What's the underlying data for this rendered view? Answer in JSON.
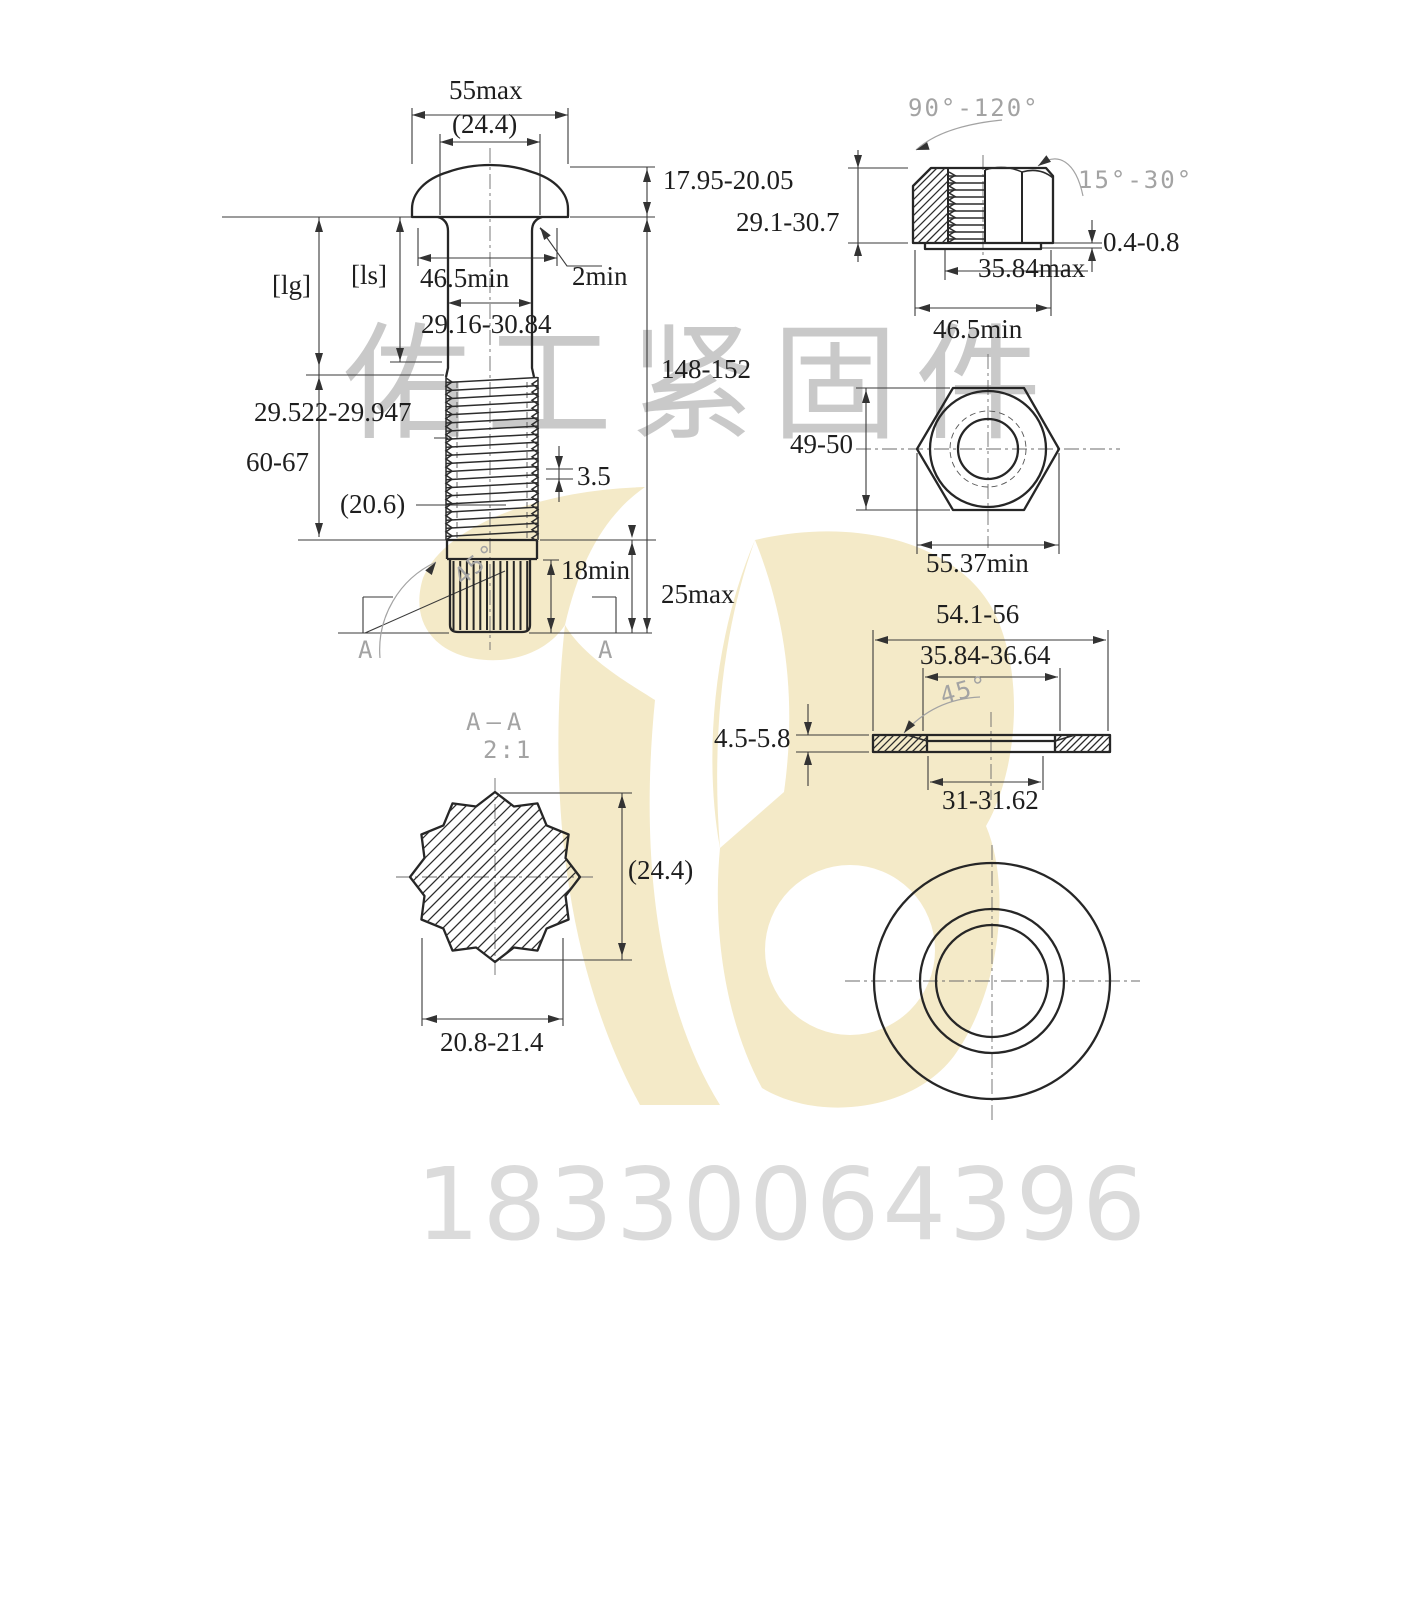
{
  "watermark": {
    "company": "佑工紧固件",
    "phone": "18330064396"
  },
  "bolt": {
    "head_width_max": "55max",
    "head_ref_dia": "(24.4)",
    "head_height": "17.95-20.05",
    "grip_ref": "[lg]",
    "shank_ref": "[ls]",
    "bearing_dia_min": "46.5min",
    "fillet_min": "2min",
    "shank_dia": "29.16-30.84",
    "overall_length": "148-152",
    "thread_major_dia": "29.522-29.947",
    "thread_length": "60-67",
    "thread_ref_dia": "(20.6)",
    "thread_pitch": "3.5",
    "chamfer_angle": "45°",
    "spline_length_min": "18min",
    "end_length_max": "25max",
    "section_mark_left": "A",
    "section_mark_right": "A"
  },
  "nut": {
    "countersink_angle": "90°-120°",
    "thread_chamfer_angle": "15°-30°",
    "height": "29.1-30.7",
    "washer_face_height": "0.4-0.8",
    "thread_dia_max": "35.84max",
    "bearing_dia_min": "46.5min",
    "across_flats": "49-50",
    "across_corners_min": "55.37min"
  },
  "washer": {
    "outer_dia": "54.1-56",
    "recess_dia": "35.84-36.64",
    "chamfer_angle": "45°",
    "thickness": "4.5-5.8",
    "inner_dia": "31-31.62"
  },
  "section_aa": {
    "title": "A—A",
    "scale": "2:1",
    "od_ref": "(24.4)",
    "spline_dia": "20.8-21.4"
  },
  "colors": {
    "paper": "#ffffff",
    "line": "#262626",
    "dimension": "#3a3a3a",
    "annotation_gray": "#a3a3a3",
    "watermark_yellow": "#f4eac8",
    "watermark_text_gray": "#c9c9c9",
    "phone_gray": "#dbdbdb"
  }
}
